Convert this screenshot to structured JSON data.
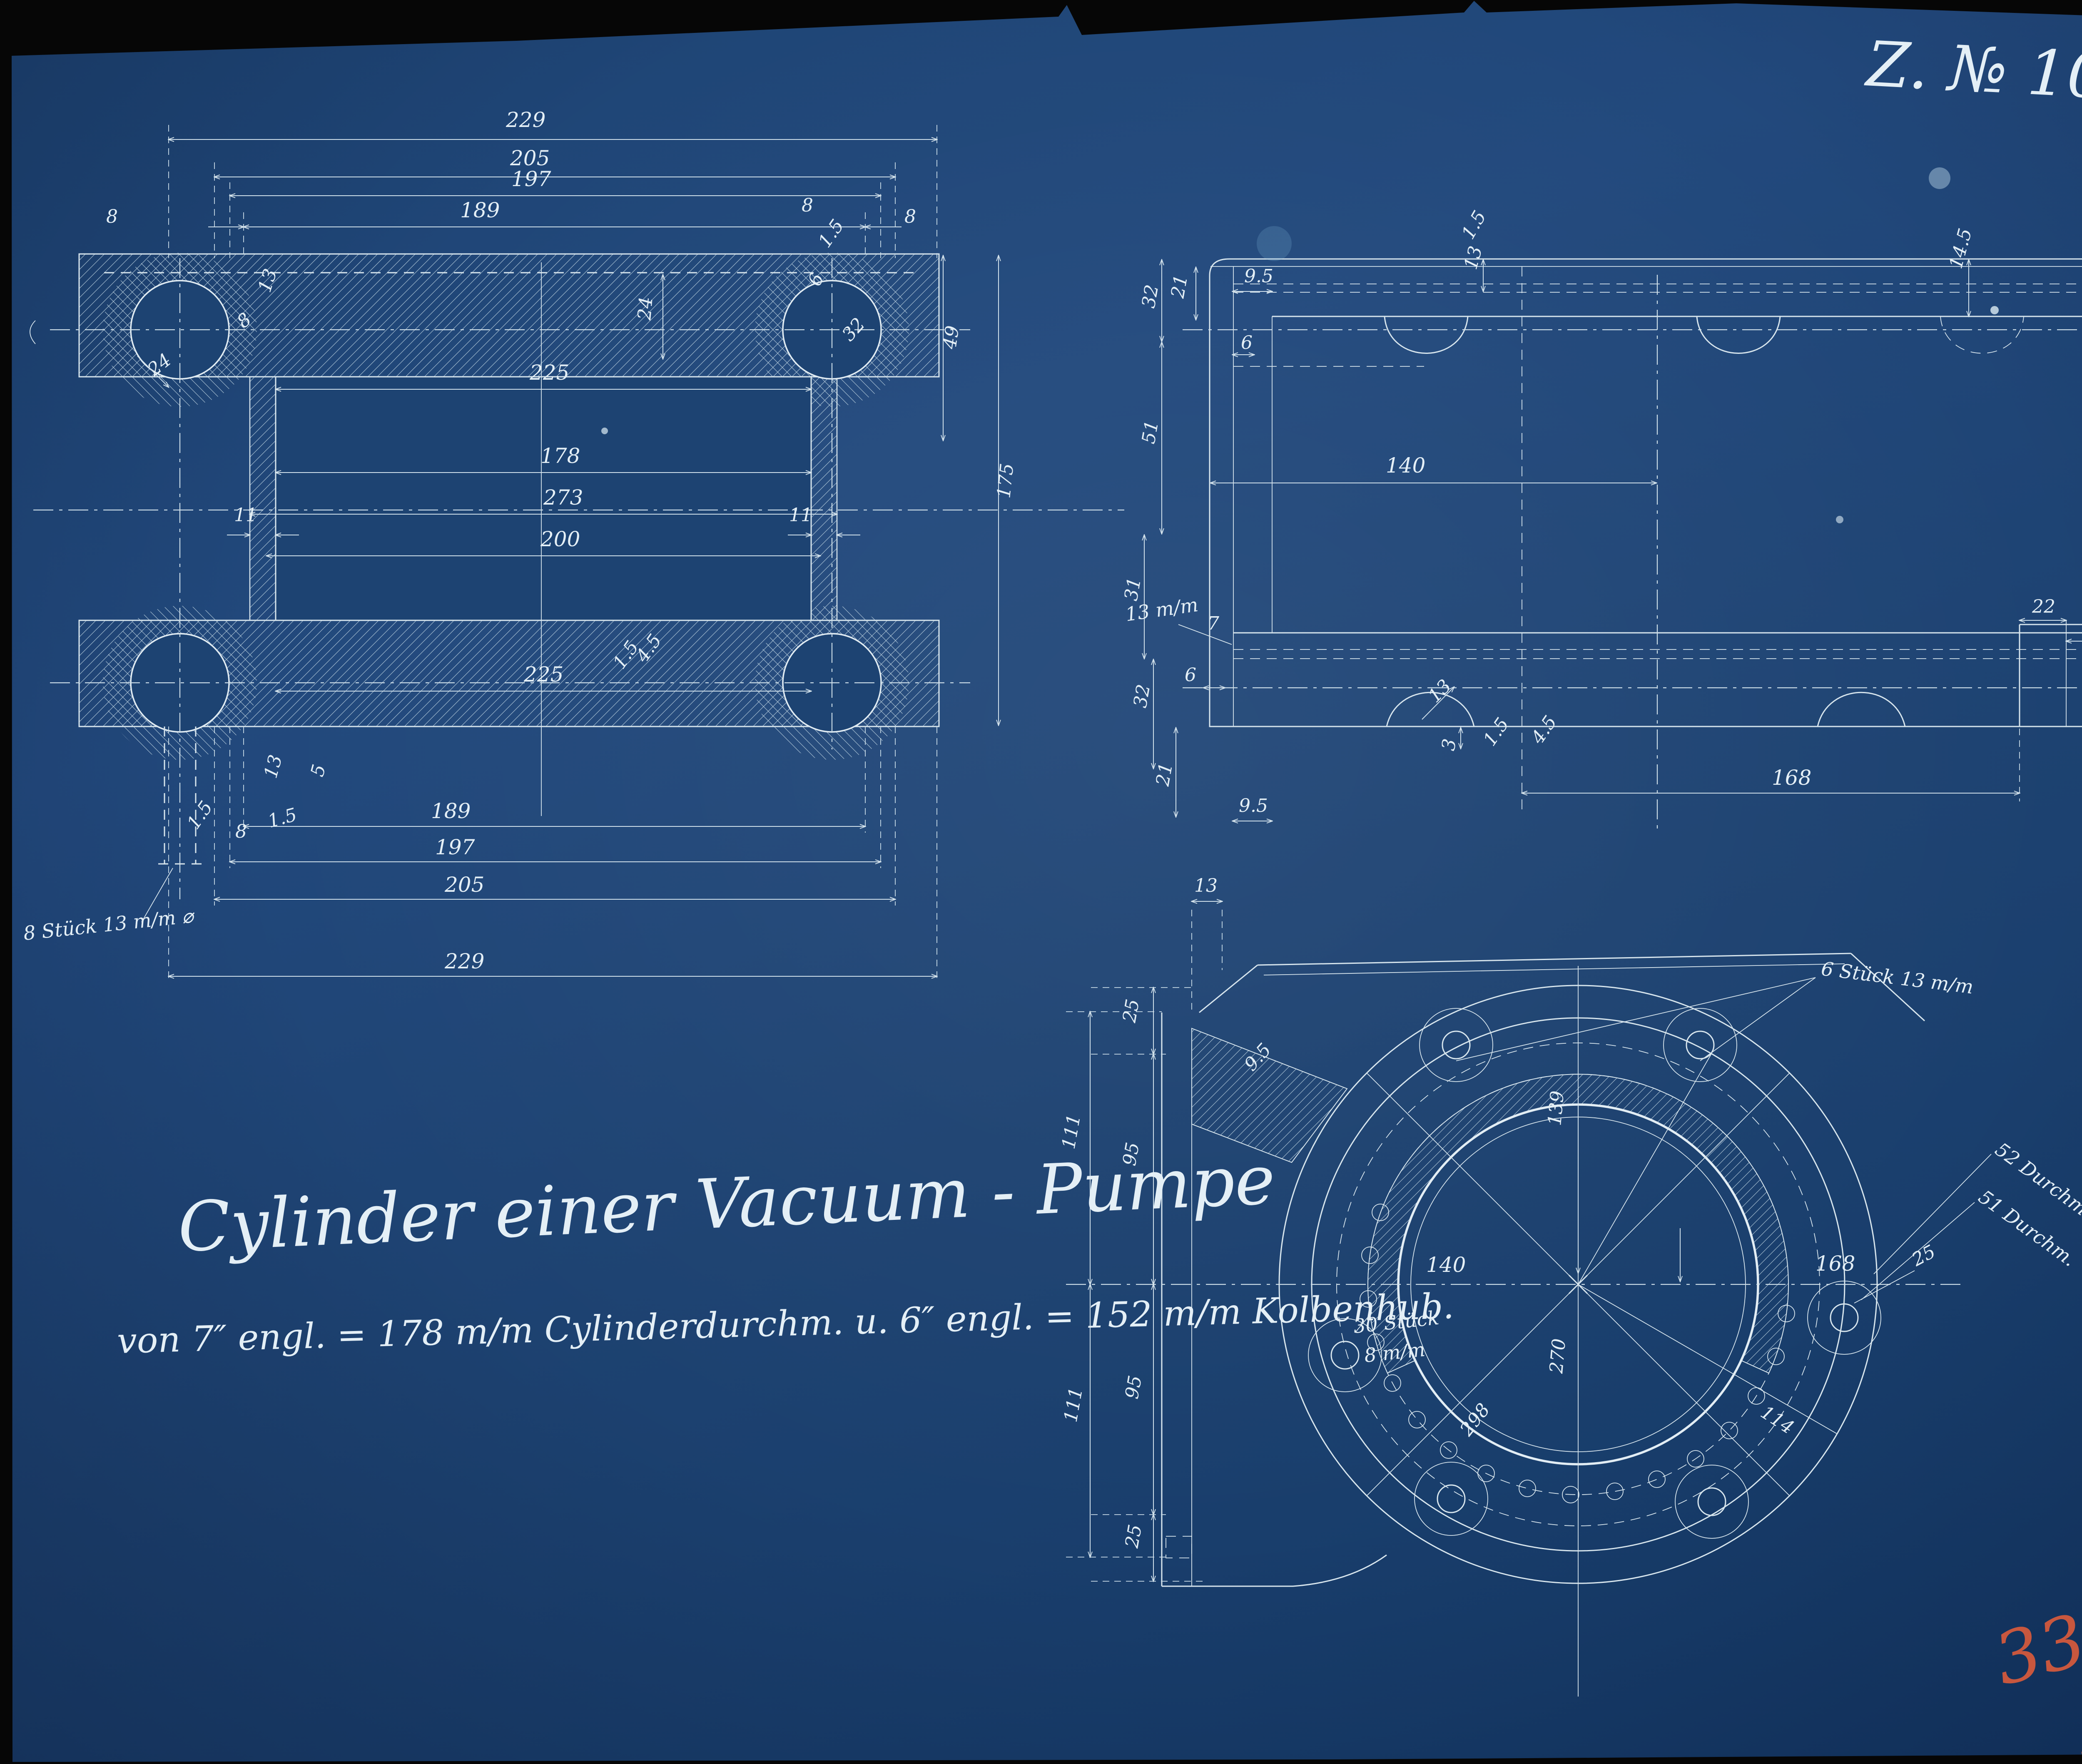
{
  "sheet": {
    "drawing_number": "Z. № 1011.",
    "title": "Cylinder einer Vacuum - Pumpe",
    "subtitle": "von 7″ engl. = 178 m/m Cylinderdurchm. u. 6″ engl. = 152 m/m Kolbenhub.",
    "colors": {
      "paper": "#1d4372",
      "line": "#d7e5ed",
      "red": "#c8573e"
    }
  },
  "marks": {
    "red_fraction": {
      "numerator": "3366",
      "denominator": "12"
    },
    "stamp_number": "187"
  },
  "front_view": {
    "dims": {
      "d229": "229",
      "d205": "205",
      "d197": "197",
      "d189": "189",
      "d8": "8",
      "d13": "13",
      "d24": "24",
      "d11": "11",
      "d225": "225",
      "d178": "178",
      "d273": "273",
      "d200": "200",
      "d32": "32",
      "d6": "6",
      "d15": "1.5",
      "d49": "49",
      "d175": "175",
      "d5": "5",
      "d45": "4.5",
      "bolt_note": "8 Stück 13 m/m ⌀"
    }
  },
  "side_view": {
    "dims": {
      "d95": "9.5",
      "d21": "21",
      "d32": "32",
      "d6": "6",
      "d51": "51",
      "d140": "140",
      "d168": "168",
      "d13": "13",
      "d15": "1.5",
      "d145": "14.5",
      "d22": "22",
      "d25": "25",
      "d3": "3",
      "d31": "31",
      "d7": "7",
      "d45": "4.5",
      "bolt_note": "13 m/m"
    }
  },
  "circle_view": {
    "dims": {
      "d168": "168",
      "d140": "140",
      "d139": "139",
      "d114": "114",
      "d298": "298",
      "d270": "270",
      "d25": "25",
      "d95": "95",
      "d111": "111",
      "d13": "13",
      "d95r": "9.5",
      "note30_line1": "30 Stück",
      "note30_line2": "8 m/m",
      "note6": "6 Stück 13 m/m",
      "note52": "52 Durchm.",
      "note51": "51 Durchm."
    }
  }
}
